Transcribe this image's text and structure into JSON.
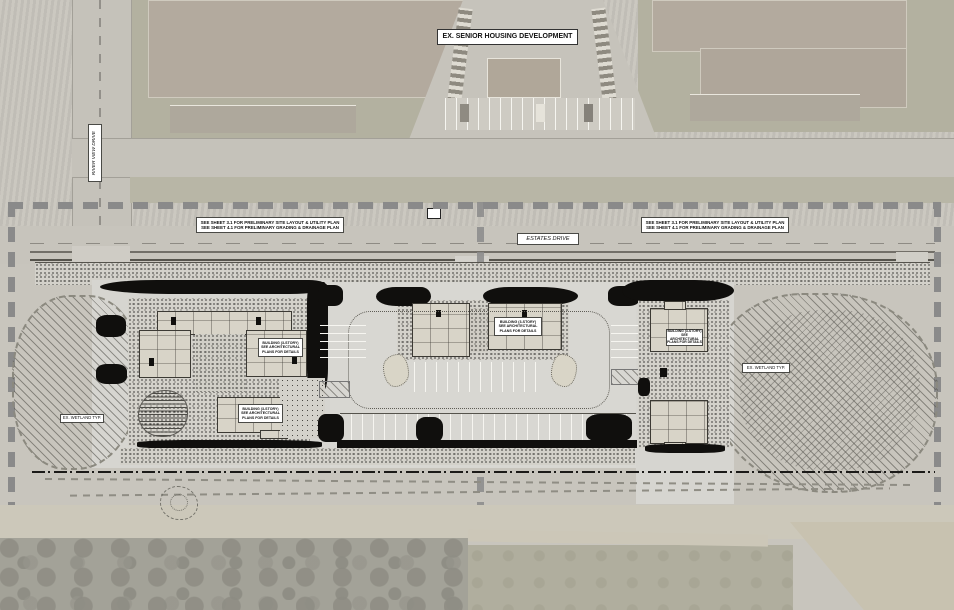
{
  "labels": {
    "existing_development": "EX. SENIOR HOUSING DEVELOPMENT",
    "river_view_drive": "RIVER VIEW DRIVE",
    "estates_drive": "ESTATES DRIVE",
    "sheet_note_line1": "SEE SHEET 3.1 FOR PRELIMINARY SITE LAYOUT & UTILITY PLAN",
    "sheet_note_line2": "SEE SHEET 4.1 FOR PRELIMINARY GRADING & DRAINAGE PLAN",
    "building_label_line1": "BUILDING (3-STORY)",
    "building_label_line2": "SEE ARCHITECTURAL",
    "building_label_line3": "PLANS FOR DETAILS",
    "wetland": "EX. WETLAND TYP."
  },
  "colors": {
    "phase_boundary": "#8a8a8a",
    "aerial_base": "#c8c5bd",
    "plan_pavement": "#d6d5d0",
    "ink": "#100f0d",
    "roof": "#b3aa9e",
    "lawn": "#b3b1a0"
  }
}
